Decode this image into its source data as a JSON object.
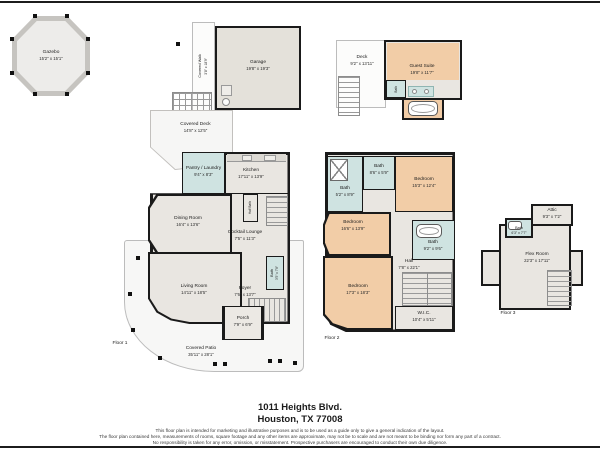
{
  "address": {
    "line1": "1011 Heights Blvd.",
    "line2": "Houston, TX 77008"
  },
  "disclaimer": {
    "line1": "This floor plan is intended for marketing and illustrative purposes and is to be used as a guide only to give a general indication of the layout.",
    "line2": "The floor plan contained here, measurements of rooms, square footage and any other items are approximate, may not be to scale and are not meant to be binding nor form any part of a contract.",
    "line3": "No responsibility is taken for any error, omission, or misstatement. Prospective purchasers are encouraged to conduct their own due diligence."
  },
  "colors": {
    "wall": "#1a1a1a",
    "room": "#e9e6e1",
    "bedroom": "#f2cda7",
    "bath": "#cfe3e1",
    "outdoor": "#f7f7f6",
    "garage": "#e4e1da"
  },
  "floor1": {
    "label": "Floor 1",
    "gazebo": {
      "name": "Gazebo",
      "dims": "15'2\" x 15'1\""
    },
    "garage": {
      "name": "Garage",
      "dims": "19'8\" x 19'3\""
    },
    "covered_walk": {
      "name": "Covered Walk",
      "dims": "3'8\" x 18'9\""
    },
    "covered_deck": {
      "name": "Covered Deck",
      "dims": "14'8\" x 12'5\""
    },
    "pantry_laundry": {
      "name": "Pantry / Laundry",
      "dims": "9'4\" x 8'3\""
    },
    "kitchen": {
      "name": "Kitchen",
      "dims": "17'11\" x 13'9\""
    },
    "dining_room": {
      "name": "Dining Room",
      "dims": "16'4\" x 13'6\""
    },
    "cocktail_lounge": {
      "name": "Cocktail Lounge",
      "dims": "7'5\" x 11'3\""
    },
    "half_bath": {
      "name": "Half Bath"
    },
    "living_room": {
      "name": "Living Room",
      "dims": "14'11\" x 18'5\""
    },
    "foyer": {
      "name": "Foyer",
      "dims": "7'6\" x 13'7\""
    },
    "bath": {
      "name": "Bath",
      "dims": "3'5\" x 7'8\""
    },
    "porch": {
      "name": "Porch",
      "dims": "7'9\" x 6'9\""
    },
    "covered_patio": {
      "name": "Covered Patio",
      "dims": "35'11\" x 28'1\""
    }
  },
  "floor2": {
    "label": "Floor 2",
    "deck": {
      "name": "Deck",
      "dims": "9'2\" x 13'11\""
    },
    "guest_suite": {
      "name": "Guest Suite",
      "dims": "19'8\" x 11'7\""
    },
    "guest_bath": {
      "name": "Bath"
    },
    "bath_front": {
      "name": "Bath",
      "dims": "5'2\" x 8'9\""
    },
    "bath_mid": {
      "name": "Bath",
      "dims": "8'6\" x 5'9\""
    },
    "bedroom_front": {
      "name": "Bedroom",
      "dims": "15'3\" x 12'4\""
    },
    "bedroom_left": {
      "name": "Bedroom",
      "dims": "16'6\" x 13'9\""
    },
    "bath_primary": {
      "name": "Bath",
      "dims": "9'2\" x 9'6\""
    },
    "hall": {
      "name": "Hall",
      "dims": "7'8\" x 22'1\""
    },
    "bedroom_primary": {
      "name": "Bedroom",
      "dims": "17'3\" x 18'3\""
    },
    "wic": {
      "name": "W.I.C.",
      "dims": "10'4\" x 5'11\""
    }
  },
  "floor3": {
    "label": "Floor 3",
    "attic": {
      "name": "Attic",
      "dims": "9'3\" x 7'2\""
    },
    "bath": {
      "name": "Bath",
      "dims": "6'3\" x 7'7\""
    },
    "flex_room": {
      "name": "Flex Room",
      "dims": "22'3\" x 17'11\""
    }
  }
}
